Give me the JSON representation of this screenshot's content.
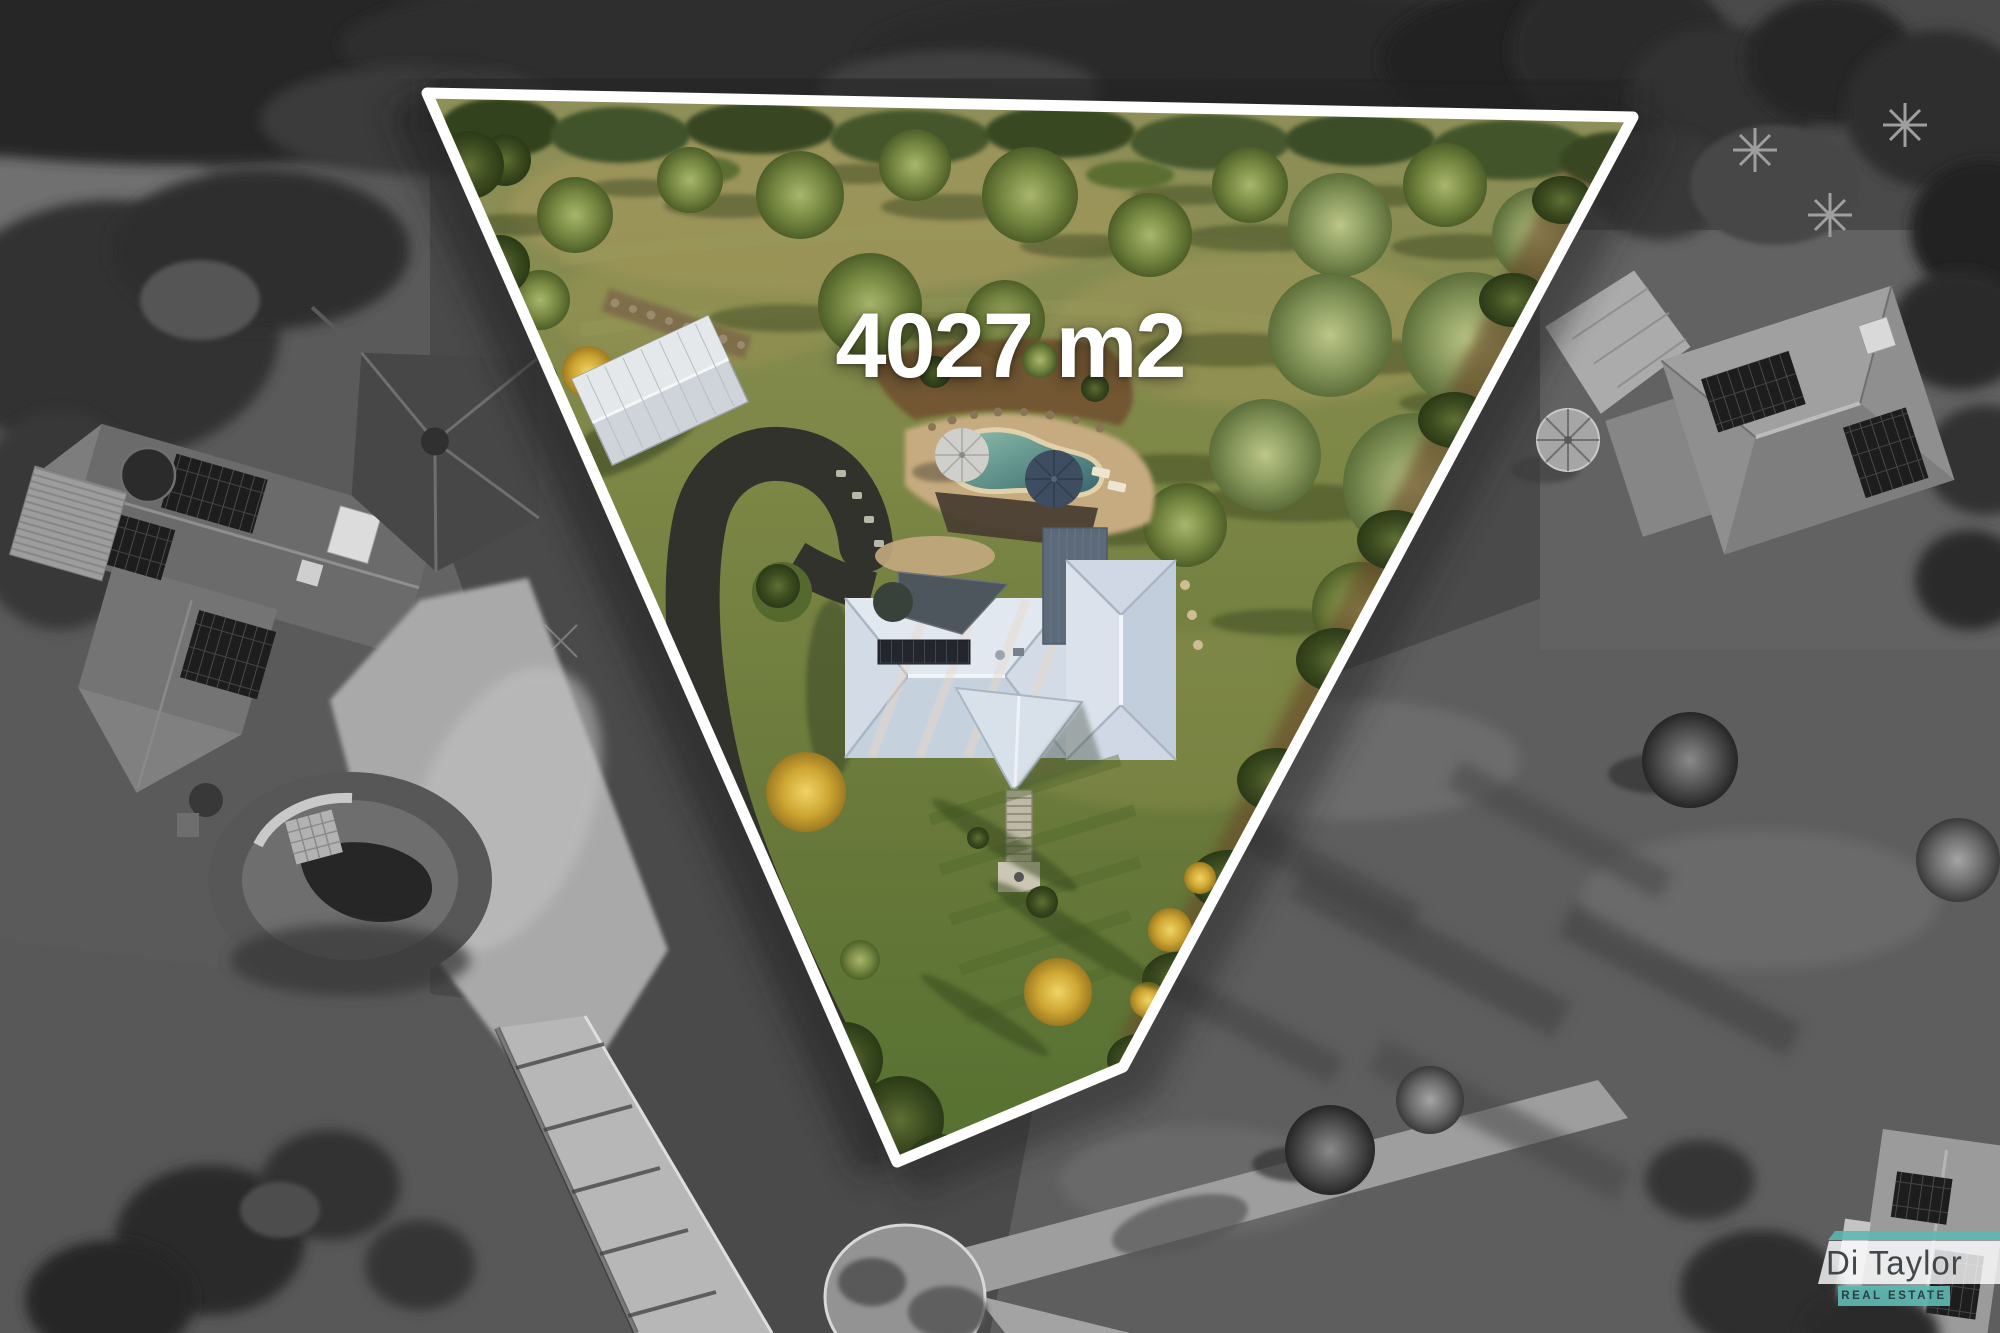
{
  "area_label": "4027 m2",
  "logo": {
    "name": "Di Taylor",
    "tagline": "REAL ESTATE"
  },
  "colors": {
    "boundary_outline": "#ffffff",
    "logo_teal": "#5cb8b2",
    "logo_name_text": "#41484d",
    "logo_tagline_text": "#2c3e44",
    "annotation_text": "#ffffff"
  },
  "boundary_vertices": "427,93 1633,117 1123,1067 897,1162"
}
